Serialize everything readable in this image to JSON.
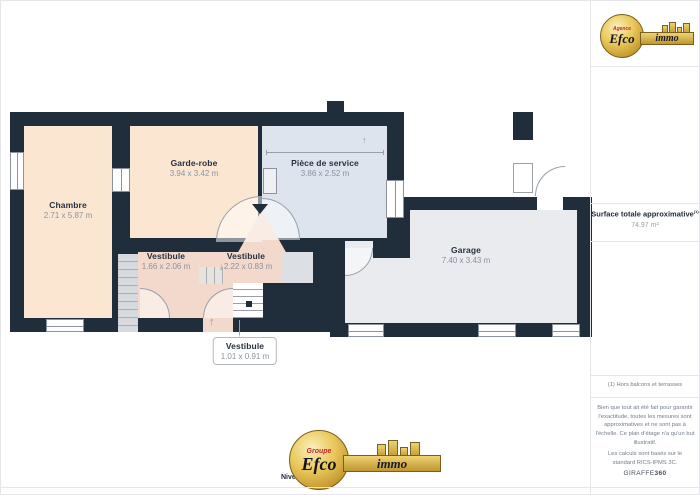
{
  "brand": {
    "header": {
      "prefix": "Agence",
      "name": "Efco",
      "suffix": "immo"
    },
    "footer": {
      "prefix": "Groupe",
      "name": "Efco",
      "suffix": "immo"
    }
  },
  "floor_label": "Niveau 0",
  "plan": {
    "chambre": {
      "name": "Chambre",
      "dims": "2.71 x 5.87 m"
    },
    "garde_robe": {
      "name": "Garde-robe",
      "dims": "3.94 x 3.42 m"
    },
    "piece_service": {
      "name": "Pièce de service",
      "dims": "3.86 x 2.52 m"
    },
    "vestibule_left": {
      "name": "Vestibule",
      "dims": "1.66 x 2.06 m"
    },
    "vestibule_mid": {
      "name": "Vestibule",
      "dims": "2.22 x 0.83 m"
    },
    "vestibule_callout": {
      "name": "Vestibule",
      "dims": "1.01 x 0.91 m"
    },
    "garage": {
      "name": "Garage",
      "dims": "7.40 x 3.43 m"
    }
  },
  "icons": {
    "stairs_down": "⤓",
    "entrance_arrow": "↑",
    "height_arrow": "↑"
  },
  "sidebar": {
    "surface_label": "Surface totale approximative",
    "surface_marker": "(1)",
    "surface_value": "74.97 m²",
    "footnote": "(1) Hors balcons et terrasses",
    "disclaimer": "Bien que tout ait été fait pour garantir l'exactitude, toutes les mesures sont approximatives et ne sont pas à l'échelle. Ce plan d'étage n'a qu'un but illustratif.",
    "standard": "Les calculs sont basés sur le standard RICS-IPMS 3C.",
    "brand_name": "GIRAFFE",
    "brand_bold": "360"
  },
  "colors": {
    "wall": "#202d3b",
    "floor_bedroom": "#fbe7d1",
    "floor_vestibule": "#f3d9cb",
    "floor_service": "#dde4ee",
    "floor_garage": "#e9ebee",
    "stairs": "#d6d9dd",
    "logo_gold": "#d9b54b",
    "logo_red": "#c8242b",
    "room_text": "#273140",
    "dim_text": "#8b92a0"
  }
}
